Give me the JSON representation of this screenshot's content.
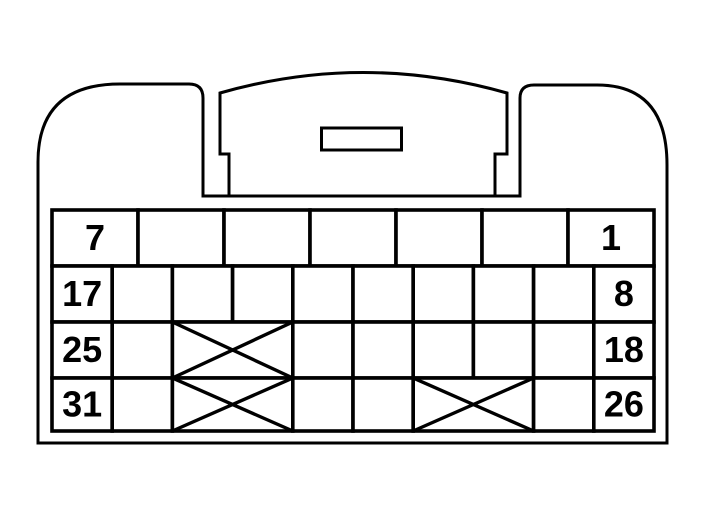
{
  "diagram": {
    "kind": "connector-pinout-face-view",
    "colors": {
      "line": "#000000",
      "background": "#ffffff"
    },
    "visible_pin_numbers": [
      "7",
      "1",
      "17",
      "8",
      "25",
      "18",
      "31",
      "26"
    ],
    "rows": [
      {
        "name": "row-1",
        "slots": 7,
        "cells": [
          {
            "label": "7"
          },
          {},
          {},
          {},
          {},
          {},
          {
            "label": "1"
          }
        ]
      },
      {
        "name": "row-2",
        "slots": 10,
        "cells": [
          {
            "label": "17"
          },
          {},
          {},
          {},
          {},
          {},
          {},
          {},
          {},
          {
            "label": "8"
          }
        ]
      },
      {
        "name": "row-3",
        "slots": 10,
        "cells": [
          {
            "label": "25"
          },
          {},
          {
            "blocked": true,
            "span": 2
          },
          {},
          {},
          {},
          {},
          {},
          {
            "label": "18"
          }
        ]
      },
      {
        "name": "row-4",
        "slots": 10,
        "cells": [
          {
            "label": "31"
          },
          {},
          {
            "blocked": true,
            "span": 2
          },
          {},
          {},
          {
            "blocked": true,
            "span": 2
          },
          {},
          {
            "label": "26"
          }
        ]
      }
    ]
  }
}
